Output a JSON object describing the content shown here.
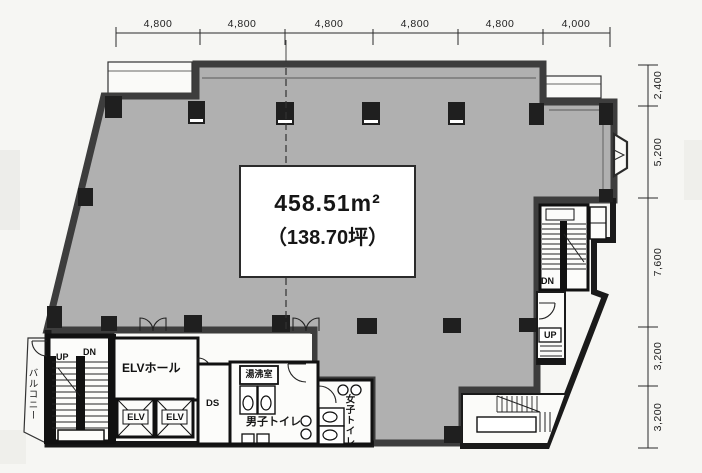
{
  "title": "floor-plan",
  "area": {
    "value": "458.51m²",
    "tsubo": "（138.70坪）"
  },
  "dims": {
    "top": [
      "4,800",
      "4,800",
      "4,800",
      "4,800",
      "4,800",
      "4,000"
    ],
    "right": [
      "2,400",
      "5,200",
      "7,600",
      "3,200",
      "3,200"
    ]
  },
  "rooms": {
    "elv_hall": "ELVホール",
    "elevator": "ELV",
    "ds": "DS",
    "kitchenette": "湯沸室",
    "mens_toilet": "男子トイレ",
    "womens_toilet": "女子トイレ",
    "balcony": "バルコニー"
  },
  "stairs": {
    "up": "UP",
    "dn": "DN"
  },
  "colors": {
    "floor_fill": "#b0b0b0",
    "wall": "#3d3d3d",
    "dark_wall": "#1a1a1a",
    "paper": "#f6f6f3"
  }
}
